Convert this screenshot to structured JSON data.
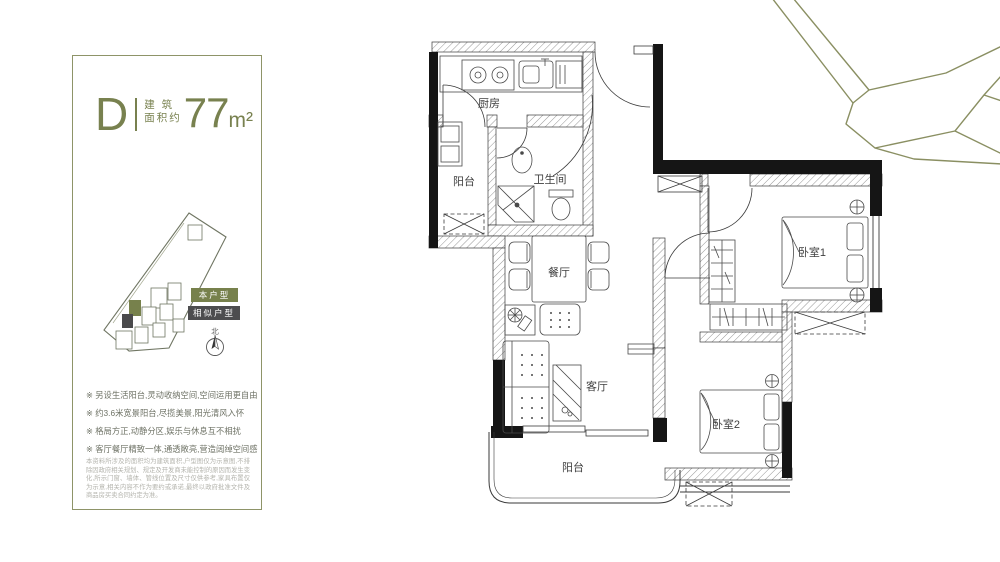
{
  "panel": {
    "plan_letter": "D",
    "area_label_top": "建 筑",
    "area_label_bottom": "面积约",
    "area_value": "77",
    "area_unit": "m²",
    "legend_current": "本户型",
    "legend_similar": "相似户型",
    "compass_north": "北",
    "features": [
      "※ 另设生活阳台,灵动收纳空间,空间运用更自由",
      "※ 约3.6米宽景阳台,尽揽美景,阳光清风入怀",
      "※ 格局方正,动静分区,娱乐与休息互不相扰",
      "※ 客厅餐厅精致一体,通透敞亮,营造阔绰空间感"
    ],
    "disclaimer": "本资料所涉及的面积均为建筑面积,户型图仅为示意图,不排除因政府相关规划、规定及开发商未能控制的原因而发生变化,所示门窗、墙体、管线位置及尺寸仅供参考,家具布置仅为示意,相关内容不作为要约或承诺,最终以政府批准文件及商品房买卖合同约定为准。"
  },
  "floorplan": {
    "rooms": {
      "kitchen": "厨房",
      "service_balcony": "阳台",
      "bathroom": "卫生间",
      "dining": "餐厅",
      "living": "客厅",
      "bedroom1": "卧室1",
      "bedroom2": "卧室2",
      "balcony": "阳台"
    }
  },
  "colors": {
    "accent_olive": "#78814f",
    "legend_green": "#77814c",
    "legend_gray": "#4d4d4f",
    "wall_black": "#151515"
  }
}
